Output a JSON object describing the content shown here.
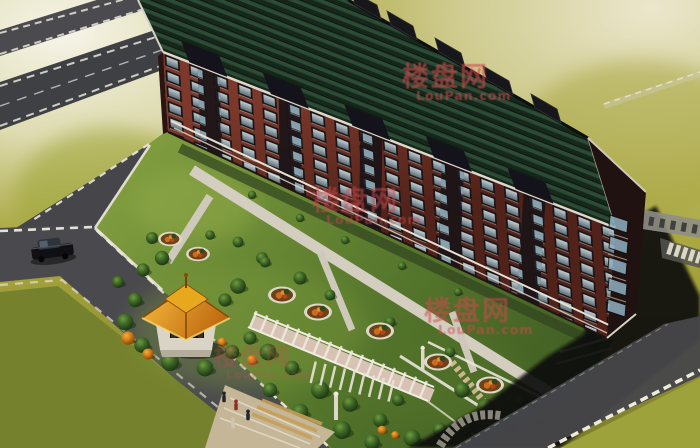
{
  "image": {
    "kind": "architectural-rendering",
    "description": "Aerial 3D rendering of a long red-brick apartment block with a dark green tiled roof, landscaped courtyard garden with orange pavilion, white pergola walkways, round flower beds, perimeter roads with dashed white curbs, a parked black car and pedestrians at the entrance plaza."
  },
  "watermark": {
    "cjk": "楼盘网",
    "latin": "LouPan.com",
    "color": "#cd4a4e"
  },
  "objects": {
    "building": "red brick apartment block, green tile roof, dark bay windows",
    "gazebo": "orange hip-roof garden pavilion",
    "pergola": "white trellis walkway",
    "car": "black sedan on perimeter road",
    "people": "pedestrians at garden entrance",
    "flower_beds": "round beds with orange flowers",
    "roads": "grey roads with dashed white curbs",
    "crosswalk": "white striped crossing at right edge"
  },
  "palette": {
    "ground_olive": "#a9a73e",
    "glow_cream": "#f2efe0",
    "roof_green": "#24402e",
    "brick_red": "#6e3226",
    "bay_dark": "#1b1418",
    "road_gray": "#46464a",
    "curb_white": "#eceadf",
    "lawn_green": "#5d7c33",
    "gazebo_orange": "#e8a81e",
    "path_light": "#d3cdbf",
    "flower_orange": "#cf6a1e",
    "shadow_dark": "#0b0b08"
  }
}
